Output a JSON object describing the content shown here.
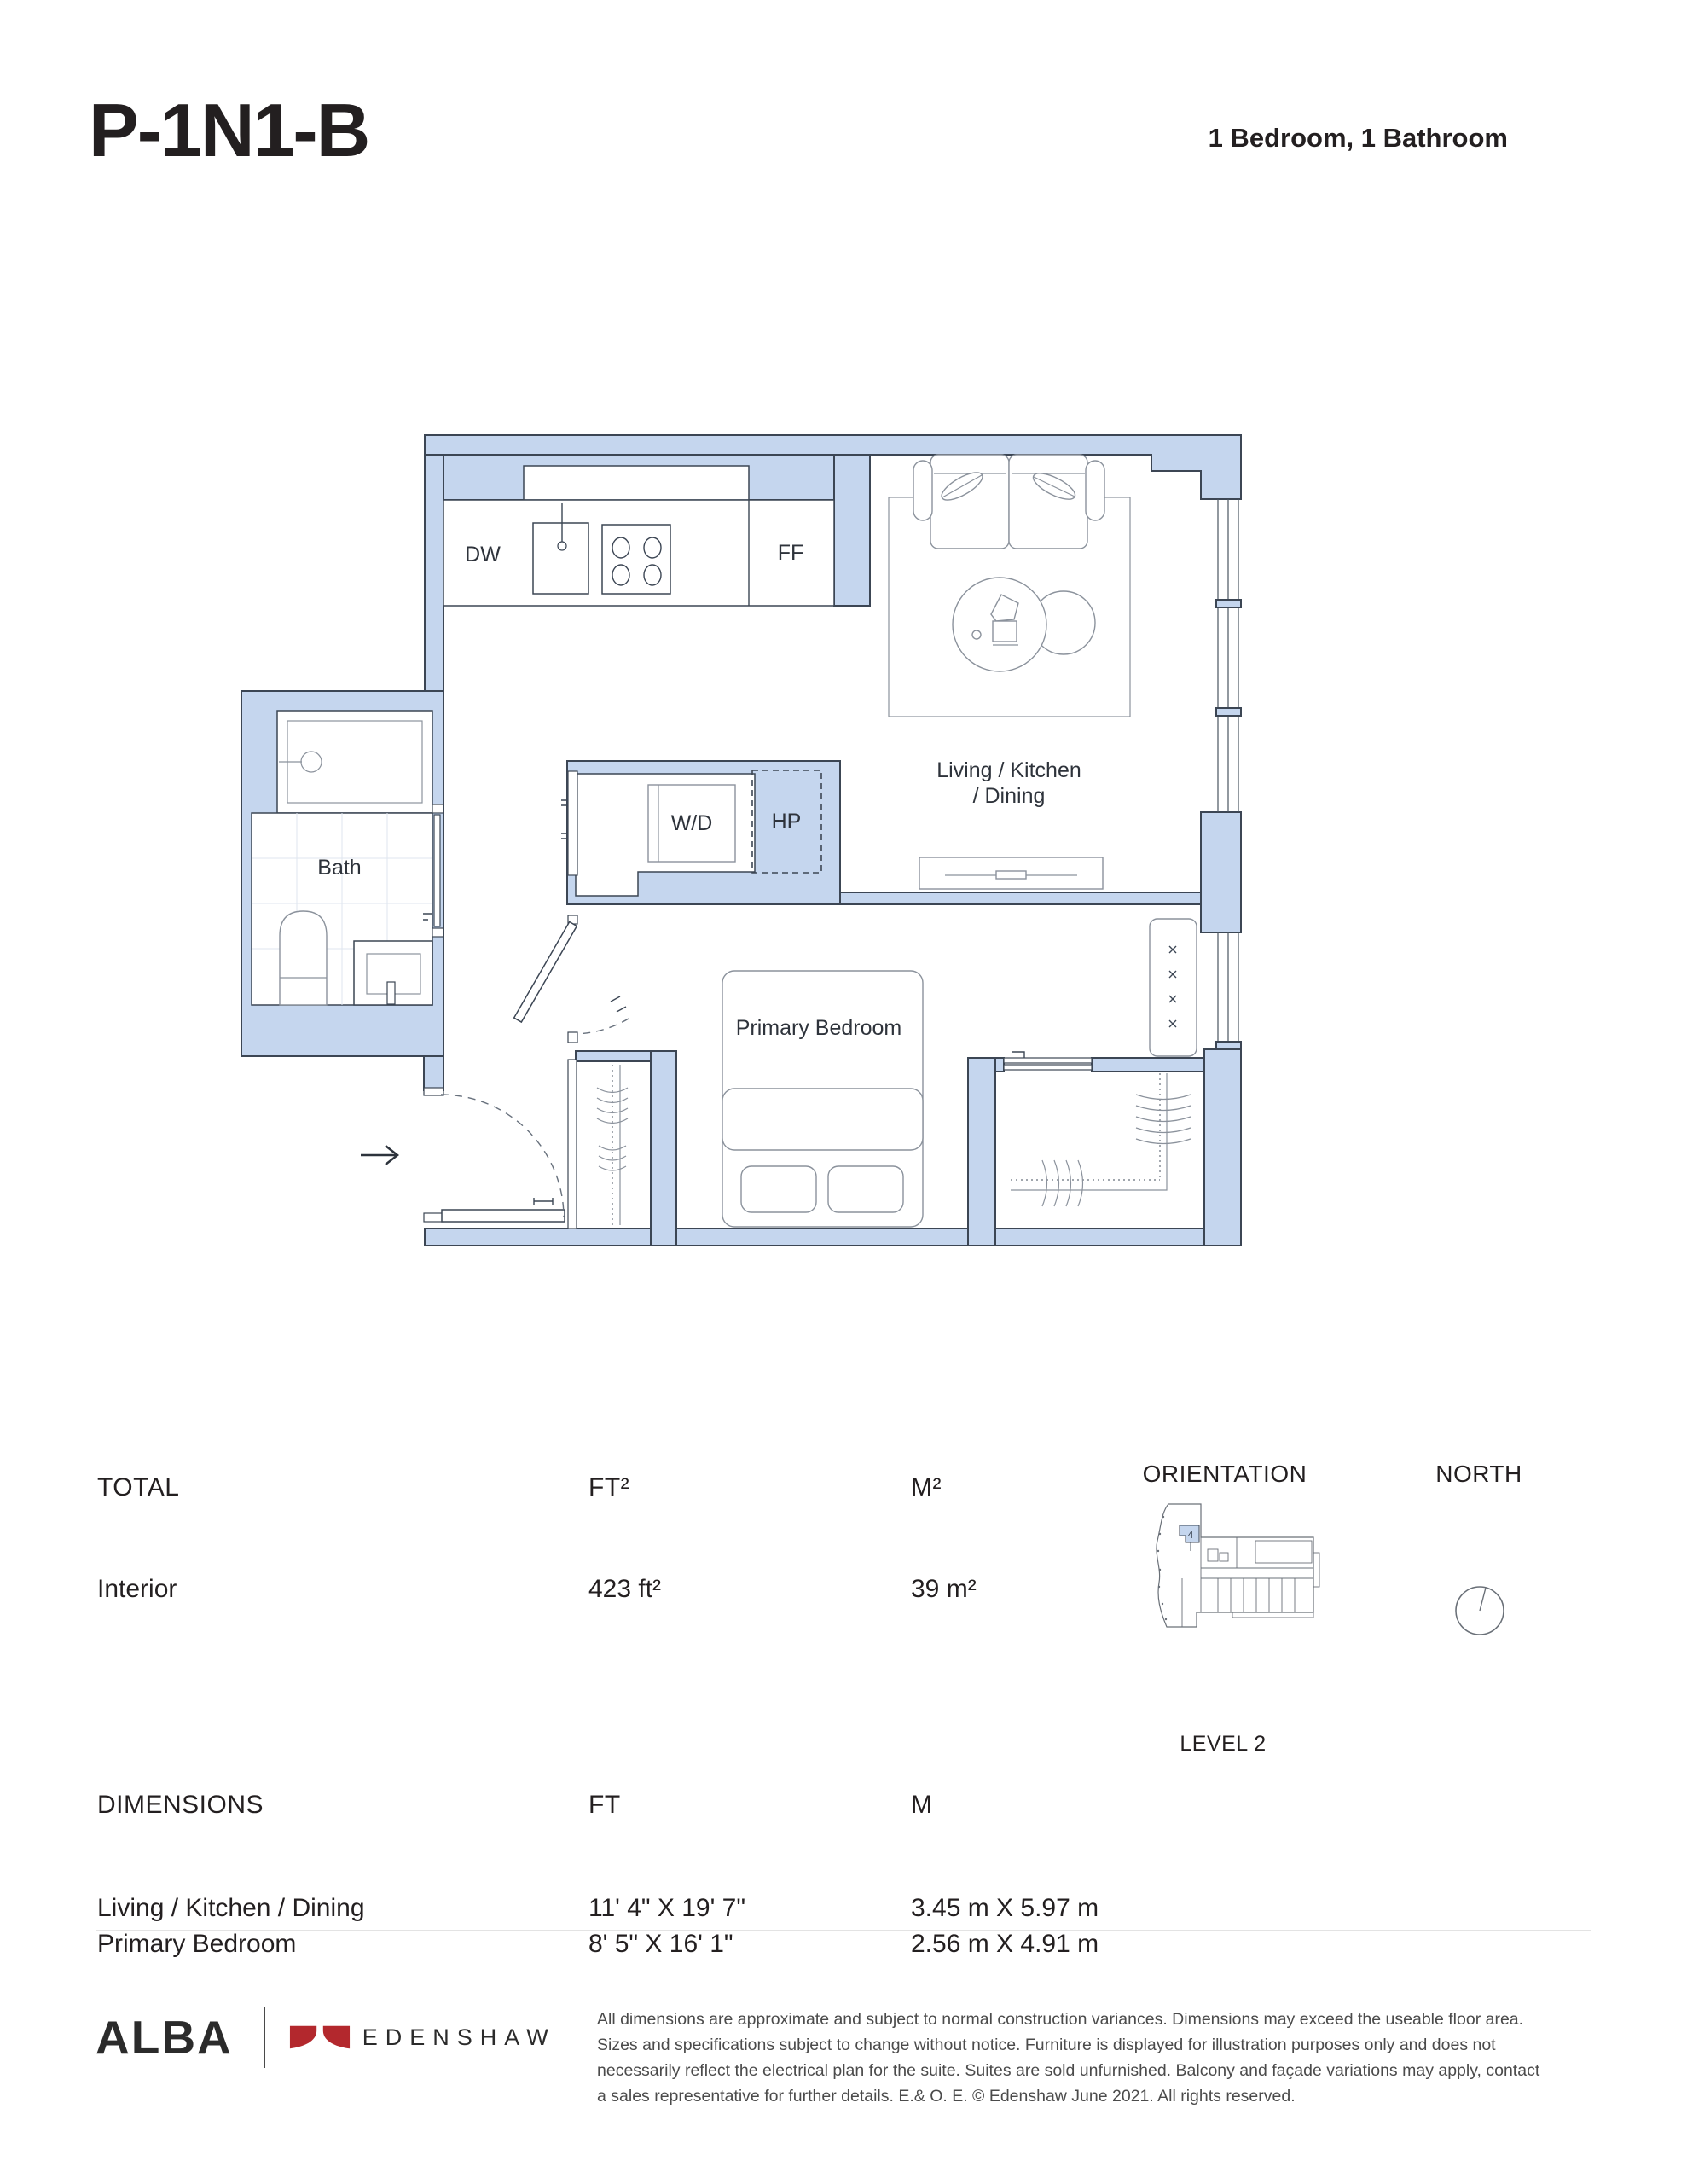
{
  "page": {
    "title": "P-1N1-B",
    "subtitle": "1 Bedroom, 1 Bathroom"
  },
  "plan": {
    "labels": {
      "dw": "DW",
      "ff": "FF",
      "wd": "W/D",
      "hp": "HP",
      "bath": "Bath",
      "living_line1": "Living / Kitchen",
      "living_line2": "/ Dining",
      "primary_bedroom": "Primary Bedroom"
    }
  },
  "total_section": {
    "header": "TOTAL",
    "ft_header": "FT²",
    "m_header": "M²",
    "rows": [
      {
        "label": "Interior",
        "ft": "423 ft²",
        "m": "39 m²"
      }
    ]
  },
  "orientation": {
    "header": "ORIENTATION",
    "unit_number": "4",
    "caption": "LEVEL 2"
  },
  "north": {
    "header": "NORTH"
  },
  "dimensions_section": {
    "header": "DIMENSIONS",
    "ft_header": "FT",
    "m_header": "M",
    "rows": [
      {
        "label": "Living / Kitchen / Dining",
        "ft": "11' 4\" X 19' 7\"",
        "m": "3.45 m X 5.97 m"
      },
      {
        "label": "Primary Bedroom",
        "ft": "8' 5\" X 16' 1\"",
        "m": "2.56 m X 4.91 m"
      }
    ]
  },
  "footer": {
    "brand": "ALBA",
    "developer": "EDENSHAW",
    "disclaimer": "All dimensions are approximate and subject to normal construction variances. Dimensions may exceed the useable floor area. Sizes and specifications subject to change without notice. Furniture is displayed for illustration purposes only and does not necessarily reflect the electrical plan for the suite. Suites are sold unfurnished. Balcony and façade variations may apply, contact a sales representative for further details. E.& O. E. © Edenshaw June 2021. All rights reserved."
  },
  "colors": {
    "wall_fill": "#c5d6ee",
    "outline": "#3c4654",
    "furniture_line": "#8b929c",
    "accent_red": "#b3282d"
  }
}
